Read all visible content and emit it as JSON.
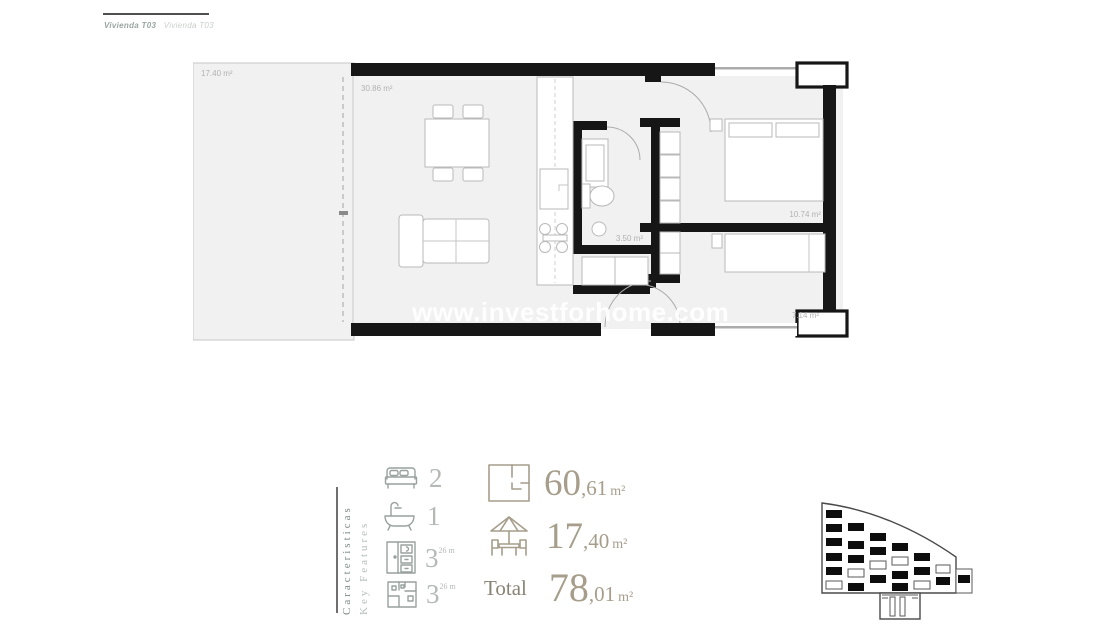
{
  "header": {
    "title_primary": "Vivienda T03",
    "title_secondary": "Vivienda T03"
  },
  "plan": {
    "watermark": "www.investforhome.com",
    "labels": {
      "terrace": "17.40 m²",
      "living": "30.86 m²",
      "bathroom": "3.50 m²",
      "bedroom1": "10.74 m²",
      "bedroom2": "7.14 m²"
    }
  },
  "features": {
    "title_es": "Caracteristicas",
    "title_en": "Key Features",
    "items": [
      {
        "name": "bedrooms",
        "icon": "bed-icon",
        "value": "2",
        "sup": ""
      },
      {
        "name": "bathrooms",
        "icon": "bath-icon",
        "value": "1",
        "sup": ""
      },
      {
        "name": "wardrobes",
        "icon": "wardrobe-icon",
        "value": "3",
        "sup": "26 m"
      },
      {
        "name": "layout",
        "icon": "layout-icon",
        "value": "3",
        "sup": "26 m"
      }
    ],
    "areas": [
      {
        "name": "built-area",
        "icon": "floorplan-icon",
        "label": "",
        "int": "60",
        "dec": ",61",
        "unit": "m²"
      },
      {
        "name": "terrace-area",
        "icon": "terrace-icon",
        "label": "",
        "int": "17",
        "dec": ",40",
        "unit": "m²"
      },
      {
        "name": "total-area",
        "icon": "",
        "label": "Total",
        "int": "78",
        "dec": ",01",
        "unit": "m²"
      }
    ]
  },
  "colors": {
    "wall": "#161616",
    "floor_fill": "#f1f1f1",
    "accent_tan": "#a69d8b",
    "muted_gray": "#b4b9b6",
    "label_gray": "#b2b2b2"
  }
}
